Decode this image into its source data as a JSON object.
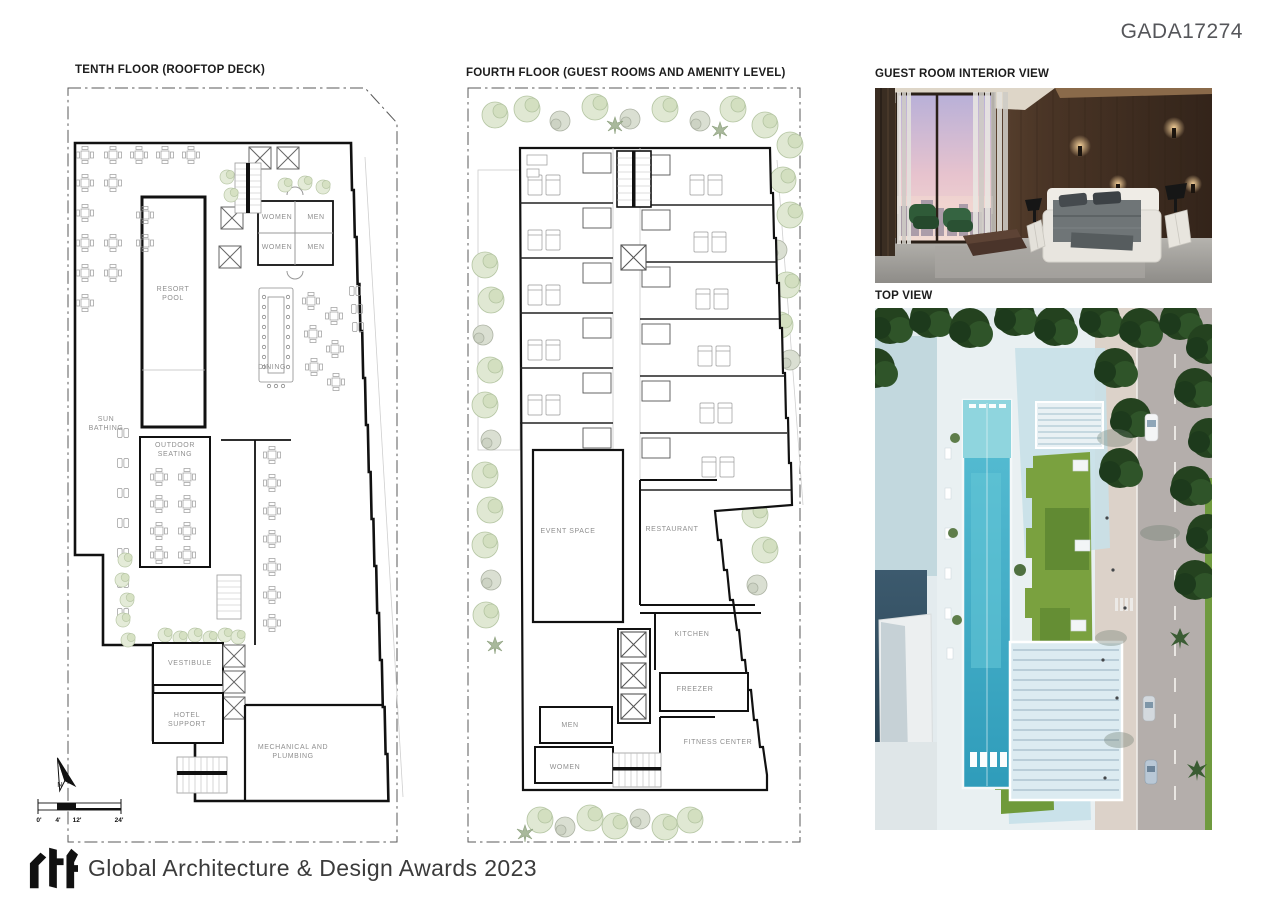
{
  "page": {
    "code": "GADA17274",
    "background": "#ffffff"
  },
  "titles": {
    "tenth": "TENTH FLOOR (ROOFTOP DECK)",
    "fourth": "FOURTH FLOOR (GUEST ROOMS AND AMENITY LEVEL)",
    "interior": "GUEST ROOM INTERIOR VIEW",
    "top_view": "TOP VIEW"
  },
  "plans": {
    "tenth": {
      "labels": [
        "WOMEN",
        "MEN",
        "WOMEN",
        "MEN",
        "RESORT POOL",
        "DINING",
        "SUN BATHING",
        "OUTDOOR SEATING",
        "VESTIBULE",
        "HOTEL SUPPORT",
        "MECHANICAL AND PLUMBING"
      ]
    },
    "fourth": {
      "labels": [
        "EVENT SPACE",
        "RESTAURANT",
        "KITCHEN",
        "FREEZER",
        "MEN",
        "WOMEN",
        "FITNESS CENTER"
      ]
    }
  },
  "compass": {
    "north": "N"
  },
  "scale_bar": {
    "ticks": [
      "0'",
      "4'",
      "12'",
      "24'"
    ]
  },
  "footer": {
    "brand": "rtf",
    "award": "Global Architecture & Design Awards 2023"
  },
  "colors": {
    "wall": "#1a1a1a",
    "label_gray": "#8f8f8f",
    "greenery": "#dde7cf",
    "pool_water": "#3aa8c4",
    "lawn_green": "#6f9a3a",
    "tree_dark": "#2c4a28",
    "wood_brown": "#5a4130",
    "sunset_sky": "#e8c8d0"
  }
}
